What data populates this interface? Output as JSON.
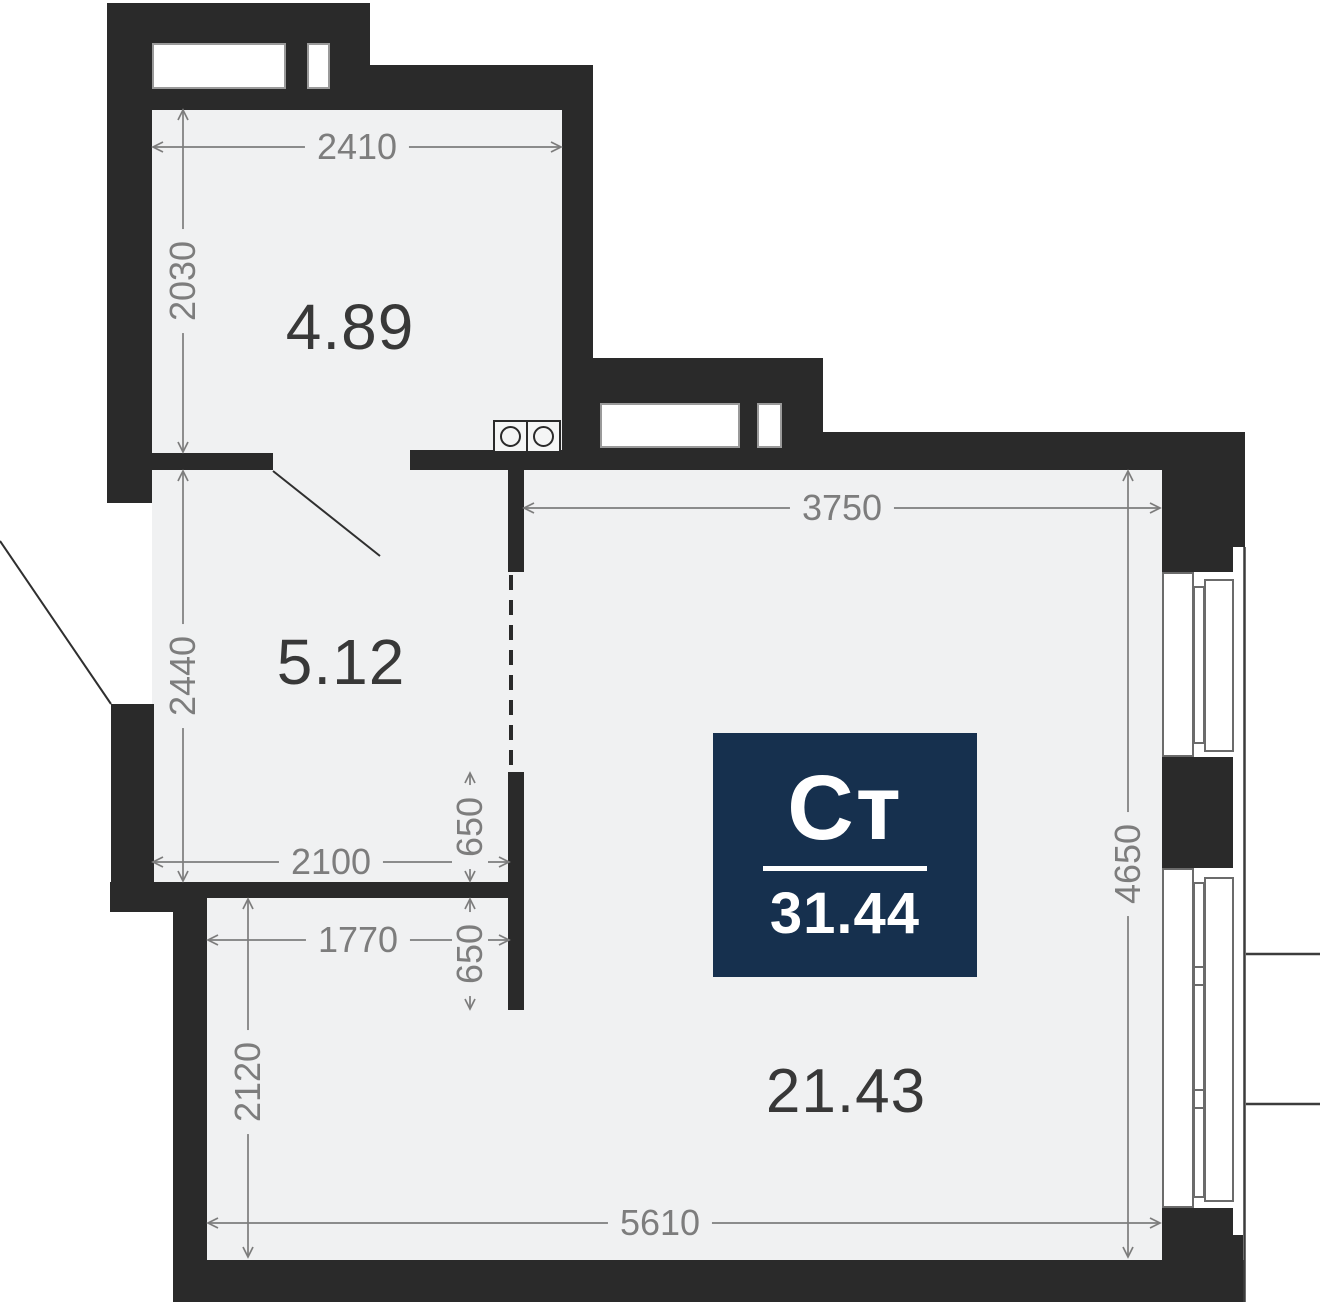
{
  "badge": {
    "type_label": "Ст",
    "total_area": "31.44"
  },
  "rooms": {
    "kitchen_area": "4.89",
    "hall_area": "5.12",
    "living_area": "21.43"
  },
  "dims": {
    "kitchen_width": "2410",
    "kitchen_height": "2030",
    "main_top_width": "3750",
    "main_right_height": "4650",
    "hall_height": "2440",
    "hall_width": "2100",
    "opening_upper": "650",
    "opening_lower": "650",
    "bottom_left_width": "1770",
    "bottom_left_height": "2120",
    "bottom_width": "5610"
  },
  "colors": {
    "wall": "#2a2a2a",
    "floor": "#f0f1f2",
    "dimension_text": "#7d7d7d",
    "room_label_text": "#383838",
    "badge_background": "#16304e",
    "badge_text": "#ffffff"
  }
}
